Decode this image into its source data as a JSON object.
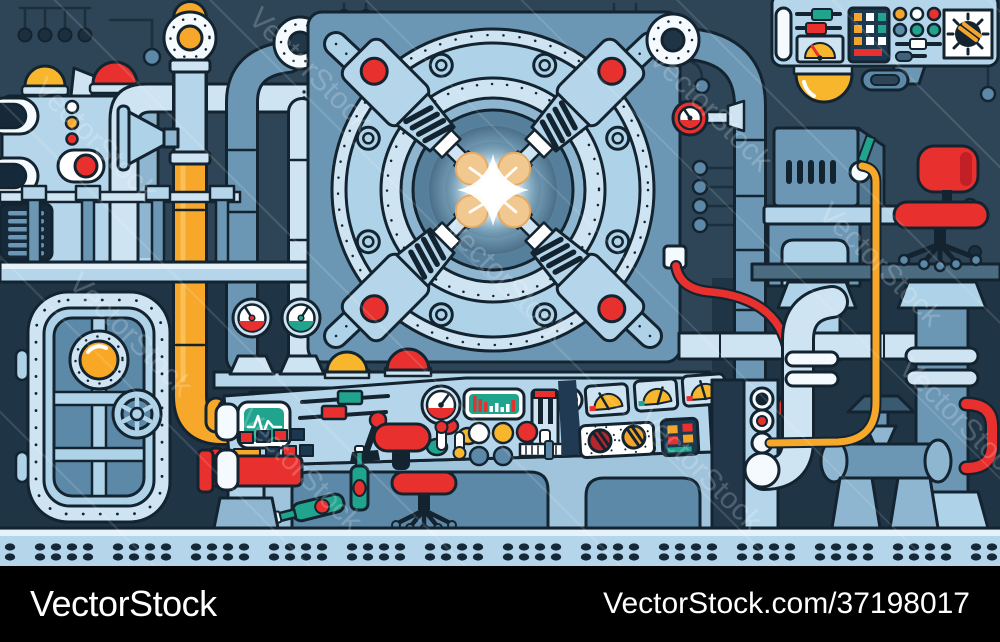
{
  "watermark": {
    "text": "VectorStock"
  },
  "footer": {
    "brand": "VectorStock",
    "image_url_label": "VectorStock.com/37198017",
    "background": "#000000",
    "text_color": "#ffffff"
  },
  "palette": {
    "background": "#2d4557",
    "dark_zone": "#1f3445",
    "outline": "#132430",
    "light_pipe": "#cfe4f2",
    "panel_light": "#b5d6ea",
    "mid_light": "#aed2e8",
    "medium_blue": "#6b96b4",
    "steel_blue": "#5d89a8",
    "navy": "#1c3850",
    "orange": "#f7a82a",
    "yellow": "#f8b62d",
    "red": "#e8302e",
    "dark_red": "#c21f26",
    "teal": "#20a48e",
    "tan_pad": "#f2c891",
    "glow_core": "#ffffff",
    "floor": "#b5d6ea",
    "rivet": "#152838"
  },
  "scene": {
    "description": "Cartoon secret-lab machine room: central round reactor portal with four clamp arms and glowing energy core, control consoles with gauges and levers, hatch door with porthole, pipes, valves, cables, chairs and riveted floor.",
    "components": [
      "reactor-portal",
      "energy-core",
      "clamp-arms",
      "hatch-door",
      "porthole",
      "door-handwheel",
      "main-control-console",
      "overhead-control-panel",
      "pressure-gauges",
      "pipes",
      "valve",
      "signal-cables",
      "office-chair",
      "stool",
      "bottles",
      "desk-machine",
      "wall-lamp",
      "riveted-floor",
      "dome-lights",
      "railing"
    ]
  }
}
